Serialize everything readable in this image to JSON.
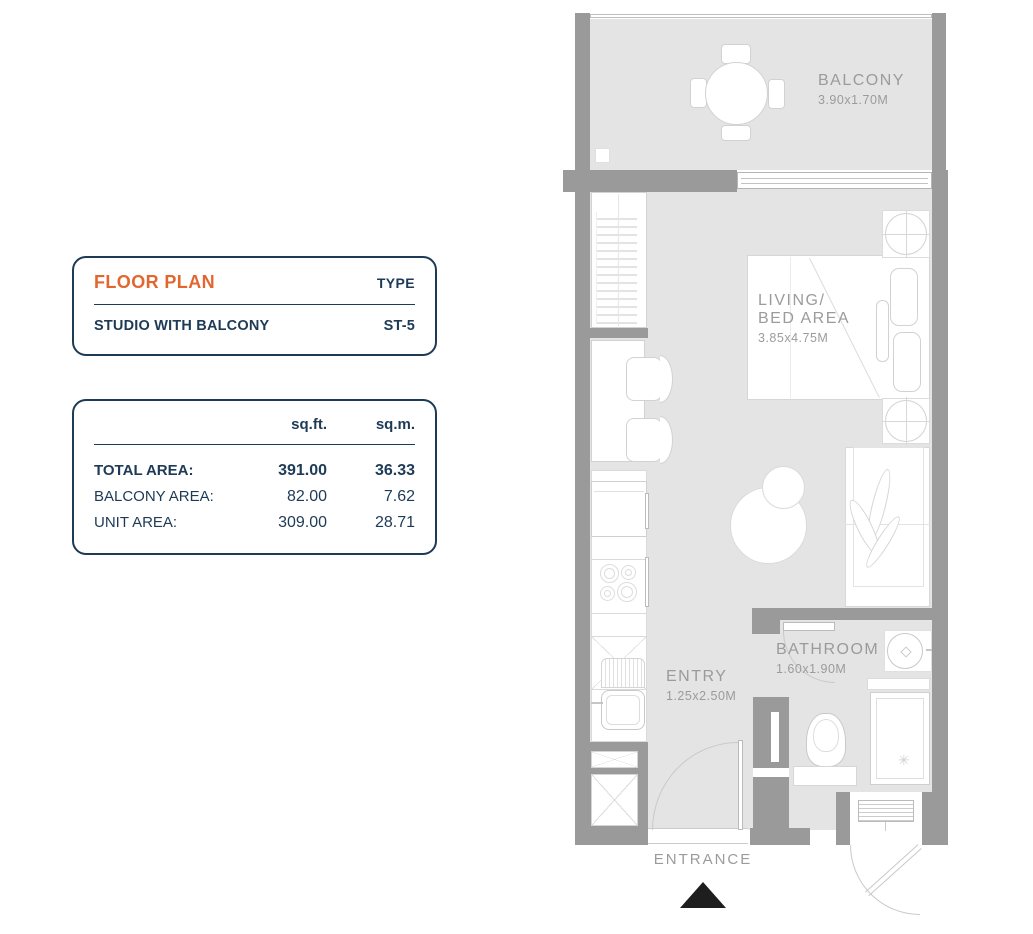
{
  "info_card": {
    "title": "FLOOR PLAN",
    "type_heading": "TYPE",
    "unit_label": "STUDIO WITH BALCONY",
    "type_code": "ST-5"
  },
  "area_card": {
    "headers": {
      "sqft": "sq.ft.",
      "sqm": "sq.m."
    },
    "rows": [
      {
        "label": "TOTAL AREA:",
        "sqft": "391.00",
        "sqm": "36.33"
      },
      {
        "label": "BALCONY AREA:",
        "sqft": "82.00",
        "sqm": "7.62"
      },
      {
        "label": "UNIT AREA:",
        "sqft": "309.00",
        "sqm": "28.71"
      }
    ]
  },
  "plan": {
    "balcony": {
      "name": "BALCONY",
      "dim": "3.90x1.70M"
    },
    "living": {
      "name_line1": "LIVING/",
      "name_line2": "BED AREA",
      "dim": "3.85x4.75M"
    },
    "bathroom": {
      "name": "BATHROOM",
      "dim": "1.60x1.90M"
    },
    "entry": {
      "name": "ENTRY",
      "dim": "1.25x2.50M"
    },
    "entrance": {
      "label": "ENTRANCE"
    }
  },
  "icons": {
    "shower_spray": "✳",
    "entrance_arrow": "▲"
  },
  "colors": {
    "accent_orange": "#e2672f",
    "navy": "#1d3a56",
    "wall_gray": "#9a9a9a",
    "floor_gray": "#e4e4e5",
    "label_gray": "#9b9b9b",
    "arrow_black": "#1e1e1e"
  }
}
